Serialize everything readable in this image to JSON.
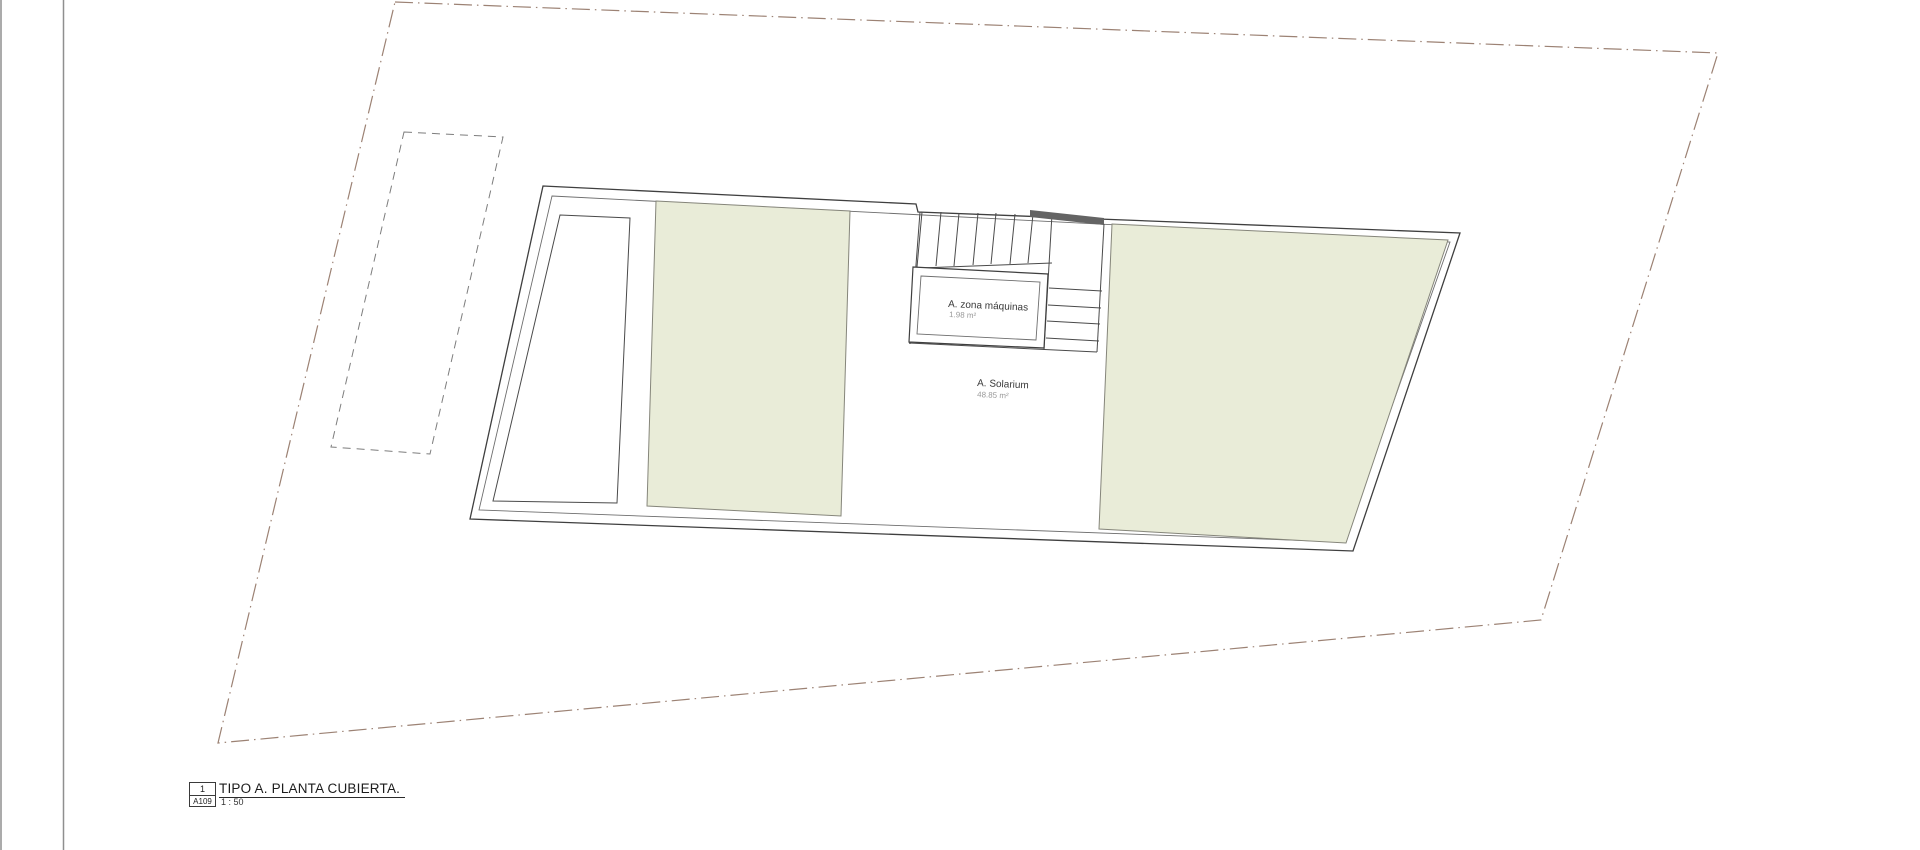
{
  "plan": {
    "machine_room_label": "A. zona máquinas",
    "machine_room_area": "1.98 m²",
    "solarium_label": "A. Solarium",
    "solarium_area": "48.85 m²"
  },
  "title_block": {
    "detail_number": "1",
    "sheet_code": "A109",
    "title": "TIPO A. PLANTA CUBIERTA.",
    "scale": "1 : 50"
  },
  "colors": {
    "terrace_fill": "#e9ecd8",
    "boundary_line": "#9c8274",
    "wall_line": "#3f3f3f",
    "stair_bar": "#646464",
    "frame_line": "#8f8f8f",
    "label_text": "#3a3a3a",
    "area_text": "#9a9a9a"
  }
}
